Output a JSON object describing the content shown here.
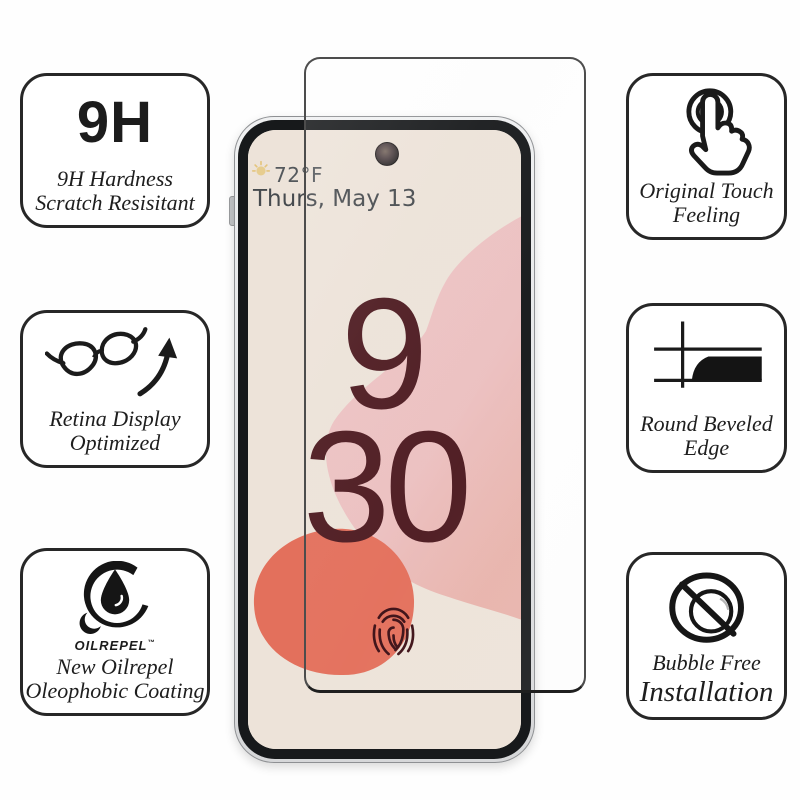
{
  "left_features": [
    {
      "badge": "9H",
      "lines": [
        "9H Hardness",
        "Scratch Resisitant"
      ]
    },
    {
      "icon": "glasses-icon",
      "lines": [
        "Retina Display",
        "Optimized"
      ]
    },
    {
      "icon": "oil-drop-icon",
      "brand": "OILREPEL",
      "brand_tm": "™",
      "lines": [
        "New Oilrepel",
        "Oleophobic Coating"
      ]
    }
  ],
  "right_features": [
    {
      "icon": "touch-icon",
      "lines": [
        "Original Touch",
        "Feeling"
      ]
    },
    {
      "icon": "beveled-edge-icon",
      "lines": [
        "Round Beveled",
        "Edge"
      ]
    },
    {
      "icon": "no-bubbles-icon",
      "lines": [
        "Bubble Free",
        "Installation"
      ]
    }
  ],
  "phone_screen": {
    "temperature": "72°F",
    "date": "Thurs, May 13",
    "clock": {
      "hour": "9",
      "minute": "30"
    }
  },
  "colors": {
    "box_border": "#272727",
    "icon_ink": "#1a1a1a",
    "screen_beige": "#ede3d9",
    "blob_pink": "#eec5c6",
    "blob_salmon": "#e8b3ab",
    "blob_coral": "#e3705c",
    "clock_maroon": "#4e1b21",
    "fingerprint_maroon": "#3d1016",
    "weather_text": "#54585c"
  }
}
